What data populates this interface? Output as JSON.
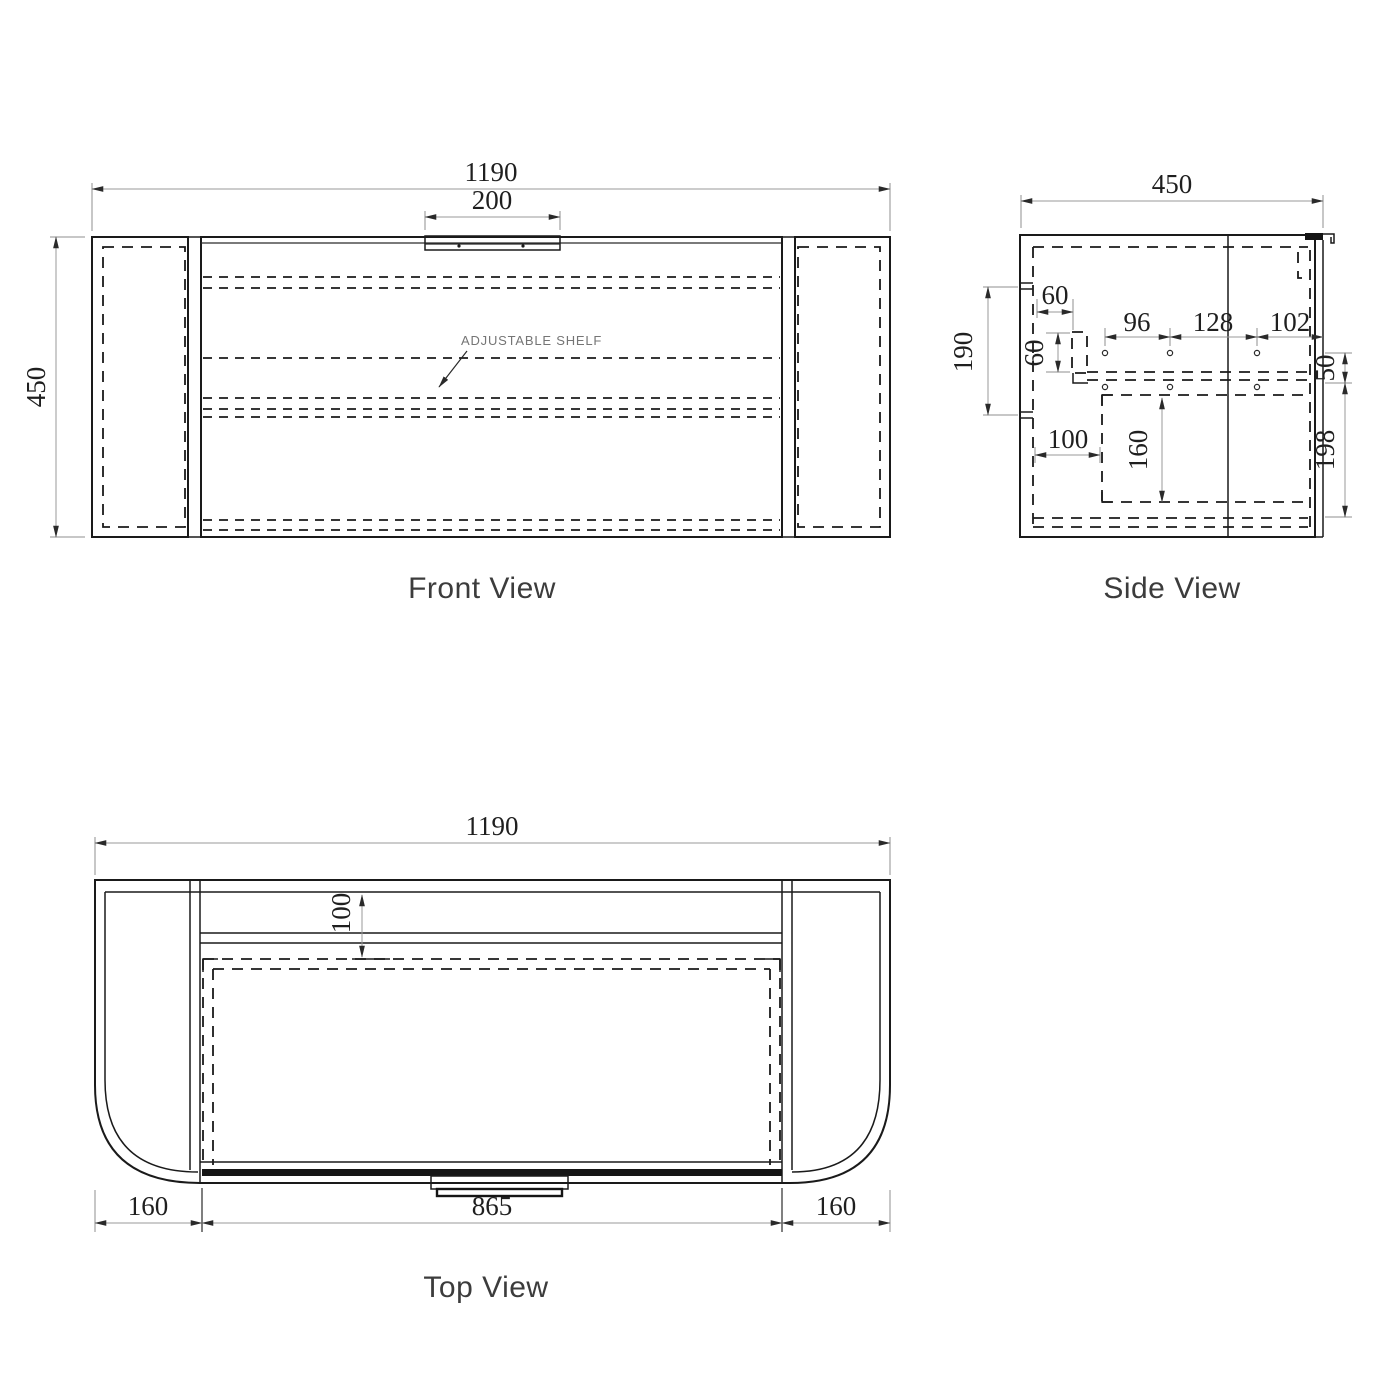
{
  "drawing": {
    "front": {
      "label": "Front View",
      "note": "ADJUSTABLE SHELF",
      "overall_width": "1190",
      "handle_width": "200",
      "overall_height": "450"
    },
    "side": {
      "label": "Side View",
      "overall_depth": "450",
      "hinge_offset_h": "60",
      "hinge_offset_v": "60",
      "hole_pitch_front": "96",
      "hole_pitch_mid": "128",
      "hole_pitch_back": "102",
      "mount_height": "190",
      "hole_row_gap": "50",
      "drawer_front_inset": "100",
      "drawer_runner_depth": "160",
      "runner_bottom_gap": "198"
    },
    "top": {
      "label": "Top View",
      "overall_width": "1190",
      "back_clearance": "100",
      "carcass_width": "865",
      "left_end_width": "160",
      "right_end_width": "160"
    },
    "colors": {
      "line": "#1a1a1a",
      "dim_text": "#1f1f1f",
      "label_text": "#3c3c3c",
      "note_text": "#757575",
      "background": "#ffffff"
    }
  }
}
